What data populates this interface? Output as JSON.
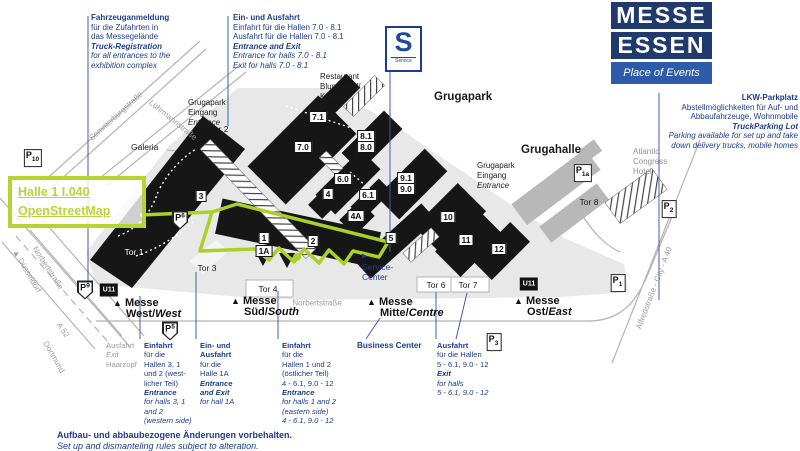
{
  "tooltip": {
    "hall_link": "Halle 1 I.040",
    "map_link": "OpenStreetMap"
  },
  "logo": {
    "line1": "MESSE",
    "line2": "ESSEN",
    "tagline": "Place of Events"
  },
  "blocks": {
    "truck_registration": {
      "title": "Fahrzeuganmeldung",
      "de1": "für die Zufahrten in",
      "de2": "das Messegelände",
      "en_title": "Truck-Registration",
      "en1": "for all entrances to the",
      "en2": "exhibition complex"
    },
    "top_entrance": {
      "title": "Ein- und Ausfahrt",
      "de1": "Einfahrt für die Hallen 7.0 - 8.1",
      "de2": "Ausfahrt für die Hallen 7.0 - 8.1",
      "en_title": "Entrance and Exit",
      "en1": "Entrance for halls 7.0 - 8.1",
      "en2": "Exit for halls 7.0 - 8.1"
    },
    "lkw": {
      "title": "LKW-Parkplatz",
      "de1": "Abstellmöglichkeiten für Auf- und",
      "de2": "Abbaufahrzeuge, Wohnmobile",
      "en_title": "TruckParking Lot",
      "en1": "Parking available for set up and take",
      "en2": "down delivery trucks, mobile homes"
    }
  },
  "map": {
    "halls": {
      "h71": "7.1",
      "h70": "7.0",
      "h81": "8.1",
      "h80": "8.0",
      "h60": "6.0",
      "h61": "6.1",
      "h4": "4",
      "h4a": "4A",
      "h3": "3",
      "h91": "9.1",
      "h90": "9.0",
      "h5": "5",
      "h10": "10",
      "h11": "11",
      "h12": "12",
      "h1": "1",
      "h1a": "1A",
      "h2": "2"
    },
    "gates": {
      "tor1": "Tor 1",
      "tor2": "Tor 2",
      "tor3": "Tor 3",
      "tor4": "Tor 4",
      "tor6": "Tor 6",
      "tor7": "Tor 7",
      "tor8": "Tor 8"
    },
    "p_letter": "P",
    "parking_sub": {
      "p10": "10",
      "p9": "9",
      "p6": "6",
      "p5": "5",
      "p3": "3",
      "p2": "2",
      "p1": "1",
      "p1a": "1a"
    },
    "ubahn": "U11",
    "sbahn": {
      "letter": "S",
      "label": "Service"
    },
    "service_marker": "▶",
    "entrance_marker": "▲",
    "places": {
      "grugapark": "Grugapark",
      "grugahalle": "Grugahalle",
      "galeria": "Galeria",
      "restaurant": {
        "l1": "Restaurant",
        "l2": "Blumenhof/",
        "l3": "Kurhaus"
      },
      "hotel": {
        "l1": "Atlantic",
        "l2": "Congress",
        "l3": "Hotel"
      },
      "service_center": {
        "l1": "Service-",
        "l2": "Center"
      },
      "gruga_entrance": {
        "l1": "Grugapark",
        "l2": "Eingang",
        "l3": "Entrance"
      }
    },
    "streets": {
      "sommerburg": "Sommerburgstraße",
      "luehrmann": "Lührmannstraße",
      "norbert_w": "Norbertstraße",
      "norbert_s": "Norbertstraße",
      "duesseldorf": "▲ Düsseldorf",
      "a52": "A 52",
      "dortmund": "Dortmund",
      "alfred": "Alfredstraße - City - A 40"
    },
    "entrances": {
      "west": {
        "name": "Messe",
        "de": "West/",
        "en": "West"
      },
      "sued": {
        "name": "Messe",
        "de": "Süd/",
        "en": "South"
      },
      "mitte": {
        "name": "Messe",
        "de": "Mitte/",
        "en": "Centre"
      },
      "ost": {
        "name": "Messe",
        "de": "Ost/",
        "en": "East"
      }
    }
  },
  "columns": {
    "haarzopf": {
      "l1": "Ausfahrt",
      "l2": "Exit",
      "l3": "Haarzopf"
    },
    "west_entrance": {
      "l1": "Einfahrt",
      "l2": "für die",
      "l3": "Hallen 3, 1",
      "l4": "und 2 (west-",
      "l5": "licher Teil)",
      "l6": "Entrance",
      "l7": "for halls 3, 1",
      "l8": "and 2",
      "l9": "(western side)"
    },
    "hall1a": {
      "l1": "Ein- und",
      "l2": "Ausfahrt",
      "l3": "für die",
      "l4": "Halle 1A",
      "l5": "Entrance",
      "l6": "and Exit",
      "l7": "for hall 1A"
    },
    "east_entrance": {
      "l1": "Einfahrt",
      "l2": "für die",
      "l3": "Hallen 1 und 2",
      "l4": "(östlicher Teil)",
      "l5": "4 - 6.1, 9.0 - 12",
      "l6": "Entrance",
      "l7": "for halls 1 and 2",
      "l8": "(eastern side)",
      "l9": "4 - 6.1, 9.0 - 12"
    },
    "business": "Business Center",
    "east_exit": {
      "l1": "Ausfahrt",
      "l2": "für die Hallen",
      "l3": "5 - 6.1, 9.0 - 12",
      "l4": "Exit",
      "l5": "for halls",
      "l6": "5 - 6.1, 9.0 - 12"
    }
  },
  "disclaimer": {
    "de": "Aufbau- und abbaubezogene Änderungen vorbehalten.",
    "en": "Set up and dismanteling rules subject to alteration."
  },
  "colors": {
    "accent_green": "#b5d430",
    "brand_navy": "#203a6d",
    "brand_blue": "#2d5ba9",
    "text_blue": "#1d3c8f"
  }
}
